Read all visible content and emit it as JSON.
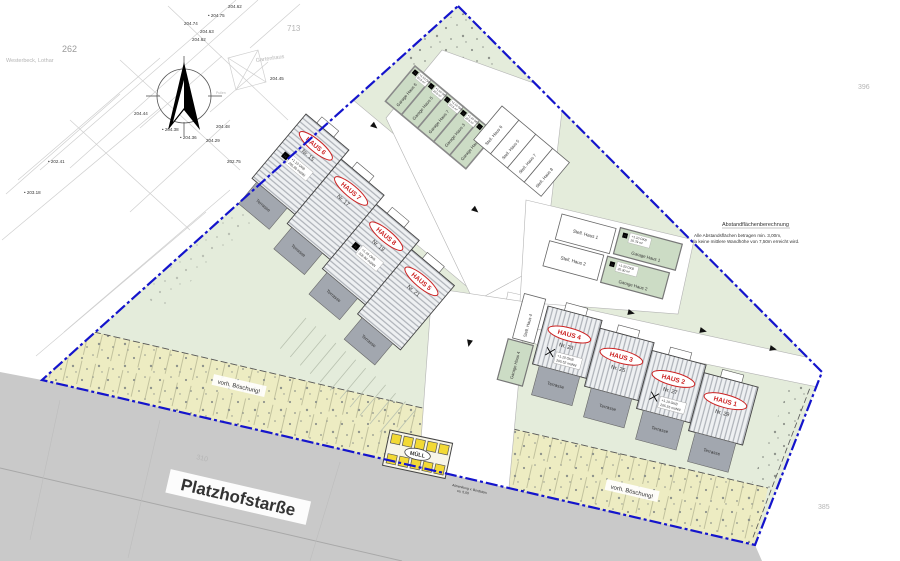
{
  "colors": {
    "boundary_blue": "#1414cc",
    "site_green": "#e4ecdb",
    "slope_yellow": "#edecc2",
    "street_grey": "#c9c9c9",
    "garage_green": "#ccdcc5",
    "terrace_grey": "#a2a7af",
    "haus_label_red": "#cc2222",
    "bin_yellow": "#f2d935"
  },
  "cadastral": {
    "parcel_262": "262",
    "parcel_713": "713",
    "parcel_396": "396",
    "parcel_385": "385",
    "owner": "Westerbeck, Lothar",
    "gartenhaus": "Gartenhaus",
    "pullen": "Pullen",
    "elevations": [
      "204.62",
      "• 204.75",
      "204.74",
      "204.63",
      "204.62",
      "204.45",
      "204.44",
      "204.48",
      "• 204.38",
      "• 204.36",
      "204.29",
      "202.75",
      "• 202.41",
      "• 203.18"
    ]
  },
  "blocks": {
    "left": {
      "terrace": "Terrasse",
      "houses": [
        {
          "name": "HAUS 6",
          "nr": "Nr. 15"
        },
        {
          "name": "HAUS 7",
          "nr": "Nr. 17"
        },
        {
          "name": "HAUS 8",
          "nr": "Nr. 19"
        },
        {
          "name": "HAUS 5",
          "nr": "Nr. 21"
        }
      ]
    },
    "right": {
      "terrace": "Terrasse",
      "houses": [
        {
          "name": "HAUS 4",
          "nr": "Nr. 23"
        },
        {
          "name": "HAUS 3",
          "nr": "Nr. 25"
        },
        {
          "name": "HAUS 2",
          "nr": "Nr. 27"
        },
        {
          "name": "HAUS 1",
          "nr": "Nr. 29"
        }
      ]
    }
  },
  "parking": {
    "h_marker": "H",
    "garages_top": [
      "Garage Haus 6",
      "Garage Haus 5",
      "Garage Haus 7",
      "Garage Haus 3",
      "Garage Haus 8"
    ],
    "stalls_top": [
      "Stell. Haus 6",
      "Stell. Haus 5",
      "Stell. Haus 7",
      "Stell. Haus 8"
    ],
    "stalls_mid": [
      "Stell. Haus 1",
      "Stell. Haus 2"
    ],
    "garages_mid": [
      "Garage Haus 1",
      "Garage Haus 2"
    ],
    "stall_right": "Stell. Haus 4",
    "garage_right": "Garage Haus 4"
  },
  "specs": {
    "garage_top_l1": "+1.10 OKB",
    "garage_top_l2": "20.6 m²",
    "garage1_l1": "+1.10 OKB",
    "garage1_l2": "20.79 m²",
    "garage2_l1": "+1.20 OKB",
    "garage2_l2": "20.30 m²",
    "haus15_l1": "+1.10 OKB",
    "haus15_l2": "205.80 müNN",
    "haus19_l1": "+1.10 OKB",
    "haus19_l2": "205.80 müNN",
    "haus23_l1": "+1.10 OKB",
    "haus23_l2": "205.52 müNN",
    "haus27_l1": "+1.10 OKB",
    "haus27_l2": "205.55 müNN"
  },
  "annotations": {
    "slope": "vorh. Böschung!",
    "street_name": "Platzhofstarße",
    "street_number": "310",
    "curb_note_l1": "Absenkung v. Bordstein",
    "curb_note_l2": "ca. 5,00",
    "muell": "MÜLL",
    "abstand_title": "Abstandflächenberechnung",
    "abstand_l1": "Alle Abstandsflächen betragen min. 3,00m,",
    "abstand_l2": "da keine mittlere Wandhöhe von 7,50m erreicht wird."
  }
}
